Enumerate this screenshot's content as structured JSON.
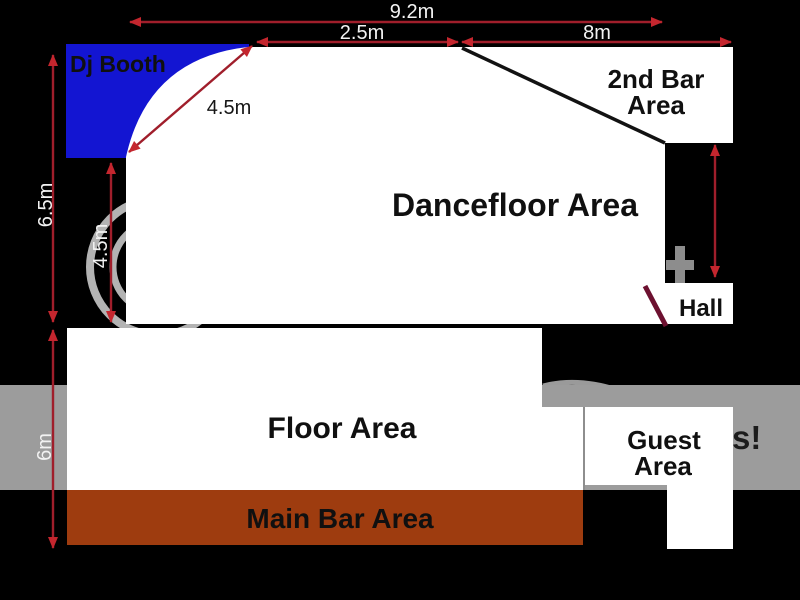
{
  "diagram_title": "Club venue floor plan",
  "areas": {
    "dj_booth": {
      "label": "Dj Booth"
    },
    "dancefloor": {
      "label": "Dancefloor Area"
    },
    "second_bar": {
      "label_line1": "2nd Bar",
      "label_line2": "Area"
    },
    "hall": {
      "label": "Hall"
    },
    "floor": {
      "label": "Floor Area"
    },
    "guest": {
      "label_line1": "Guest",
      "label_line2": "Area"
    },
    "main_bar": {
      "label": "Main Bar Area"
    }
  },
  "dimensions": {
    "top_total_width": "9.2m",
    "top_left_width": "2.5m",
    "top_right_width": "8m",
    "dancefloor_diagonal": "4.5m",
    "left_outer_height": "6.5m",
    "left_inner_height": "4.5m",
    "lower_left_height": "6m"
  },
  "watermark": {
    "fragment_left": "P",
    "fragment_right": "s!"
  },
  "colors": {
    "background_black": "#000000",
    "room_white": "#ffffff",
    "dj_booth_blue": "#1315d2",
    "dj_booth_text": "#00004a",
    "main_bar_brown": "#9e3c0f",
    "watermark_gray": "#9c9c9c",
    "watermark_ring_gray": "#b3b3b3",
    "watermark_fragment_dark": "#1c1c1c",
    "dimension_red": "#a01e2b",
    "arrowhead_red": "#c4262e",
    "divider_black": "#121212",
    "door_maroon": "#6d1130",
    "floor_label_gray": "#6f6f6f",
    "guest_label_dark": "#4f4f4f",
    "guest_label_gray": "#9d9d9d"
  }
}
